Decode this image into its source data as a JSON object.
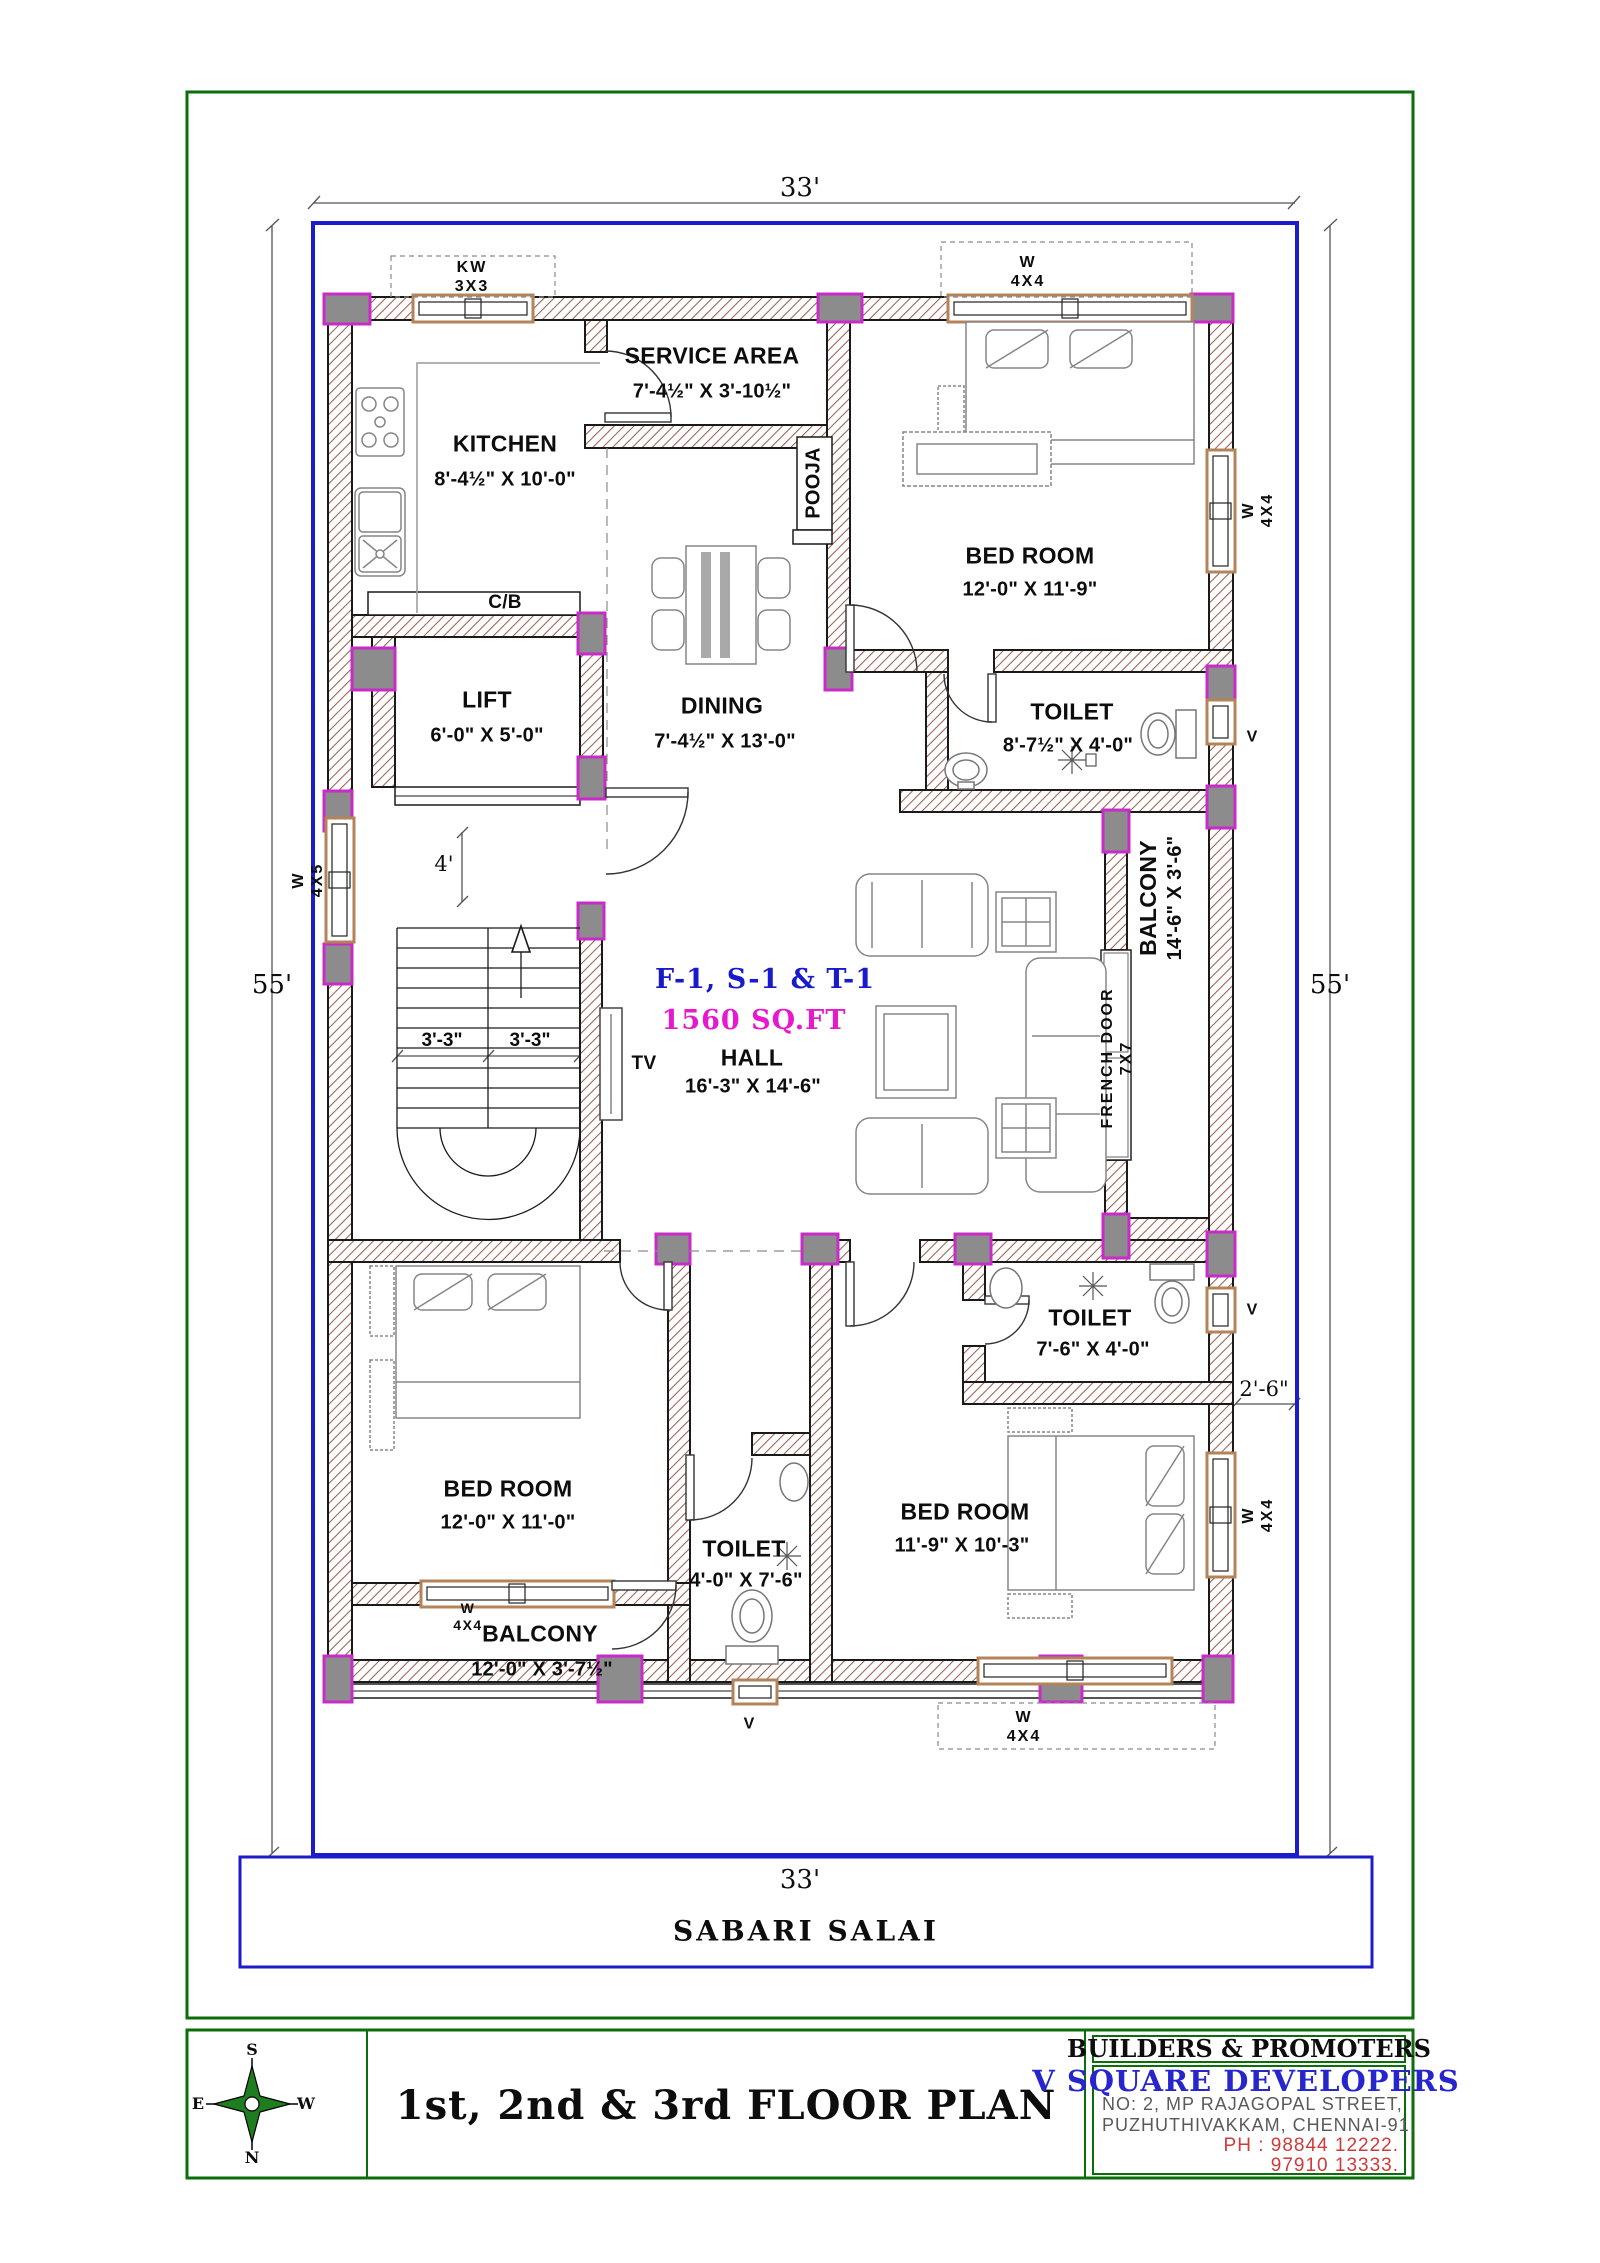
{
  "colors": {
    "boundary_blue": "#1c1ccd",
    "wall_hatch": "#9b6150",
    "column_gray": "#8c8c8c",
    "column_magenta": "#c92bc9",
    "green_border": "#0a6e0a",
    "unit_blue": "#1a1acd",
    "area_magenta": "#e619cf",
    "phone_red": "#cf3a3a"
  },
  "dimensions": {
    "top": "33'",
    "bottom": "33'",
    "left": "55'",
    "right": "55'",
    "offset_right": "2'-6\"",
    "stair_flight_left": "3'-3\"",
    "stair_flight_right": "3'-3\"",
    "landing": "4'"
  },
  "rooms": {
    "kitchen": {
      "name": "KITCHEN",
      "size": "8'-4½\" X 10'-0\""
    },
    "service_area": {
      "name": "SERVICE AREA",
      "size": "7'-4½\" X 3'-10½\""
    },
    "pooja": {
      "name": "POOJA"
    },
    "bedroom_top": {
      "name": "BED ROOM",
      "size": "12'-0\" X 11'-9\""
    },
    "toilet_top": {
      "name": "TOILET",
      "size": "8'-7½\" X 4'-0\""
    },
    "lift": {
      "name": "LIFT",
      "size": "6'-0\" X 5'-0\""
    },
    "dining": {
      "name": "DINING",
      "size": "7'-4½\" X 13'-0\""
    },
    "hall": {
      "name": "HALL",
      "size": "16'-3\" X 14'-6\"",
      "unit": "F-1, S-1 & T-1",
      "area": "1560 SQ.FT"
    },
    "balcony_right": {
      "name": "BALCONY",
      "size": "14'-6\" X 3'-6\""
    },
    "french_door": {
      "name": "FRENCH DOOR",
      "size": "7X7"
    },
    "toilet_right": {
      "name": "TOILET",
      "size": "7'-6\" X 4'-0\""
    },
    "bedroom_left": {
      "name": "BED ROOM",
      "size": "12'-0\" X 11'-0\""
    },
    "toilet_bottom": {
      "name": "TOILET",
      "size": "4'-0\" X 7'-6\""
    },
    "bedroom_right": {
      "name": "BED ROOM",
      "size": "11'-9\" X 10'-3\""
    },
    "balcony_bottom": {
      "name": "BALCONY",
      "size": "12'-0\" X 3'-7½\""
    },
    "cupboard": "C/B",
    "tv": "TV"
  },
  "windows": {
    "kitchen_window": {
      "name": "KW",
      "size": "3X3"
    },
    "bedroom_top_window": {
      "name": "W",
      "size": "4X4"
    },
    "bedroom_top_side_window": {
      "name": "W",
      "size": "4X4"
    },
    "stair_window": {
      "name": "W",
      "size": "4X5"
    },
    "balcony_window": {
      "name": "W",
      "size": "4X4"
    },
    "bedroom_bottom_window": {
      "name": "W",
      "size": "4X4"
    },
    "bedroom_right_side_window": {
      "name": "W",
      "size": "4X4"
    },
    "vent": "V"
  },
  "road": {
    "name": "SABARI SALAI"
  },
  "title_block": {
    "title": "1st, 2nd &  3rd FLOOR PLAN",
    "builders": "BUILDERS & PROMOTERS",
    "company": "V SQUARE DEVELOPERS",
    "address_line1": "NO: 2, MP RAJAGOPAL STREET,",
    "address_line2": "PUZHUTHIVAKKAM, CHENNAI-91.",
    "phone_line1": "PH : 98844 12222.",
    "phone_line2": "97910 13333.",
    "compass": {
      "top": "S",
      "bottom": "N",
      "left": "E",
      "right": "W"
    }
  }
}
